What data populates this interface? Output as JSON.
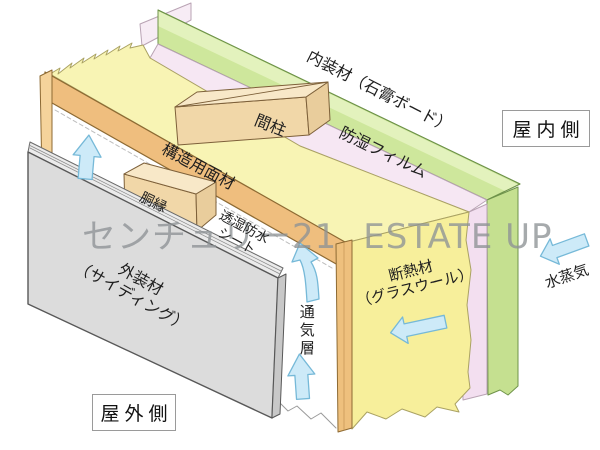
{
  "watermark": {
    "brand": "センチュリー21",
    "name": "ESTATE UP"
  },
  "zones": {
    "indoor": "屋内側",
    "outdoor": "屋外側"
  },
  "labels": {
    "interior_board": "内装材（石膏ボード）",
    "vapor_film": "防湿フィルム",
    "stud": "間柱",
    "structural_panel": "構造用面材",
    "furring": "胴縁",
    "breathable_sheet_line1": "透湿防水",
    "breathable_sheet_line2": "シート",
    "insulation_line1": "断熱材",
    "insulation_line2": "（グラスウール）",
    "siding_line1": "外装材",
    "siding_line2": "（サイディング）",
    "air_gap": "通気層",
    "vapor": "水蒸気"
  },
  "colors": {
    "interior_board": "#cee79c",
    "interior_board_top": "#e3f2bd",
    "interior_board_end": "#c5e090",
    "vapor_film": "#f6e7f3",
    "insulation_top": "#f8f4b4",
    "insulation_end": "#f7ef9b",
    "wood": "#f1d7a8",
    "wood_top": "#f8e8c8",
    "wood_side": "#e9cd9c",
    "structural_panel": "#efbe7e",
    "siding": "#dcdcdc",
    "arrow": "#cdeaf8",
    "watermark": "#8e9396",
    "label": "#1f1f1f"
  }
}
